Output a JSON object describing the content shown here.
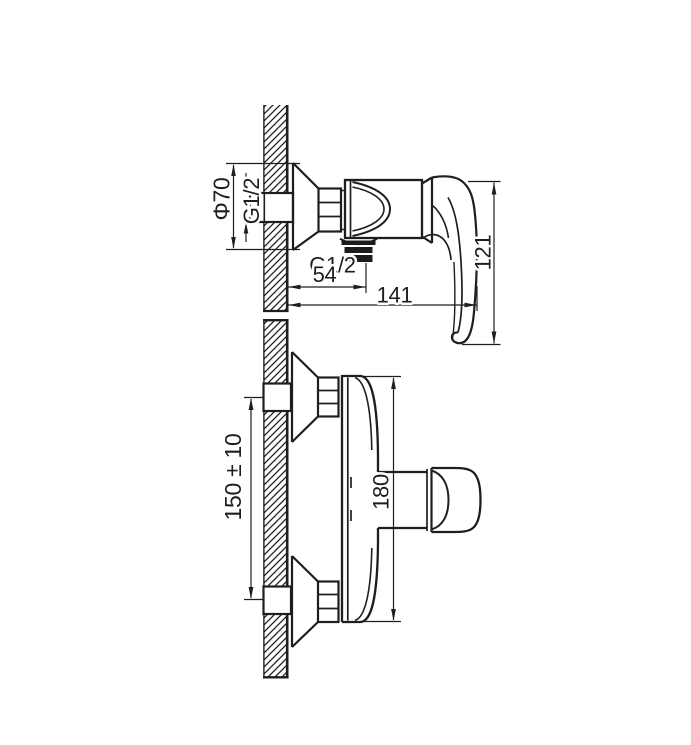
{
  "drawing": {
    "kind": "shower-mixer-installation-diagram",
    "side_view": {
      "escutcheon_diameter": "Φ70",
      "inlet_thread": "G1/2",
      "outlet_thread": "G1/2",
      "wall_to_outlet": "54",
      "wall_to_front": "141",
      "overall_height": "121"
    },
    "front_view": {
      "inlet_spacing": "150 ± 10",
      "body_span": "180"
    },
    "colors": {
      "line": "#1e1e1e",
      "background": "#ffffff"
    }
  }
}
